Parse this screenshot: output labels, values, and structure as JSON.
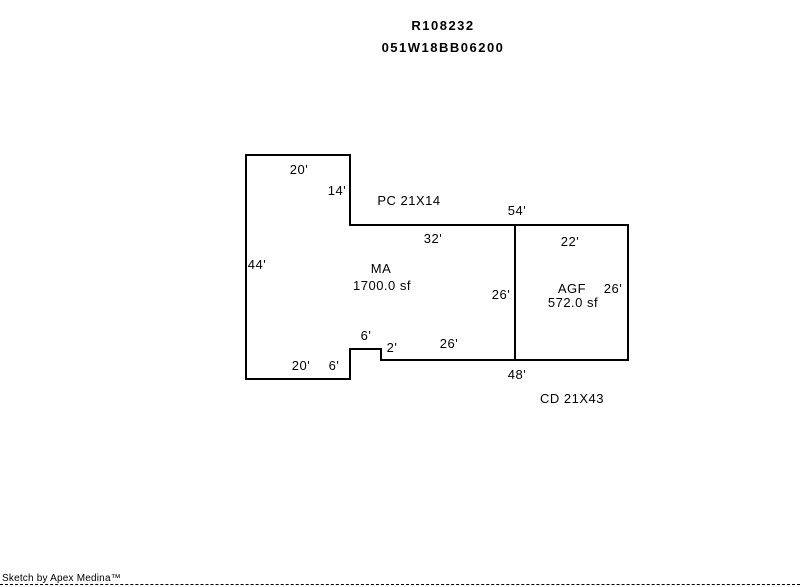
{
  "header": {
    "account": "R108232",
    "taxlot": "051W18BB06200"
  },
  "sketch": {
    "line_color": "#000000",
    "labels": {
      "top20": "20'",
      "step14": "14'",
      "pc": "PC 21X14",
      "d54": "54'",
      "d32": "32'",
      "d22": "22'",
      "d44": "44'",
      "ma_code": "MA",
      "ma_sqft": "1700.0 sf",
      "d26_interior": "26'",
      "agf_code": "AGF",
      "d26_right": "26'",
      "agf_sqft": "572.0 sf",
      "d6_upper": "6'",
      "d2": "2'",
      "d26_lower": "26'",
      "d20_bottom": "20'",
      "d6_bottom": "6'",
      "d48": "48'",
      "cd": "CD 21X43"
    }
  },
  "footer": {
    "credit": "Sketch by Apex Medina™"
  }
}
